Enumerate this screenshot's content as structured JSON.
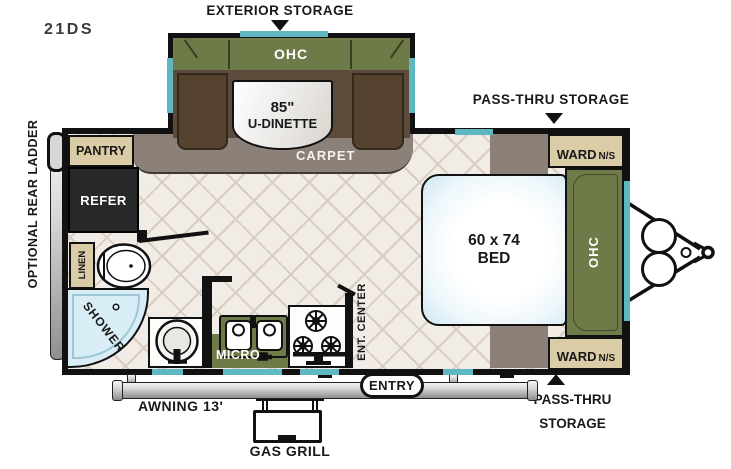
{
  "title": "21DS",
  "colors": {
    "olive": "#6F7A49",
    "seat_brown": "#5C4A3B",
    "cabinet_tan": "#D9CCA6",
    "window_teal": "#5FB7C2",
    "carpet_gray": "#8B8178",
    "floor_cream": "#F1ECE6",
    "wall_black": "#111111",
    "shower_blue": "#D8EDF5",
    "refer_dark": "#282828"
  },
  "callouts": {
    "exterior_storage": "EXTERIOR STORAGE",
    "pass_thru_top": "PASS-THRU STORAGE",
    "pass_thru_bottom_1": "PASS-THRU",
    "pass_thru_bottom_2": "STORAGE",
    "optional_rear_ladder": "OPTIONAL REAR LADDER",
    "awning": "AWNING 13'",
    "gas_grill": "GAS GRILL",
    "entry": "ENTRY"
  },
  "fixtures": {
    "slide_ohc": "OHC",
    "dinette_size": "85\"",
    "dinette": "U-DINETTE",
    "carpet": "CARPET",
    "pantry": "PANTRY",
    "refer": "REFER",
    "linen": "LINEN",
    "shower": "SHOWER",
    "micro": "MICRO",
    "ent_center": "ENT. CENTER",
    "bed_size": "60 x 74",
    "bed": "BED",
    "bed_ohc": "OHC",
    "ward": "WARD",
    "ward_ns": "N/S"
  }
}
